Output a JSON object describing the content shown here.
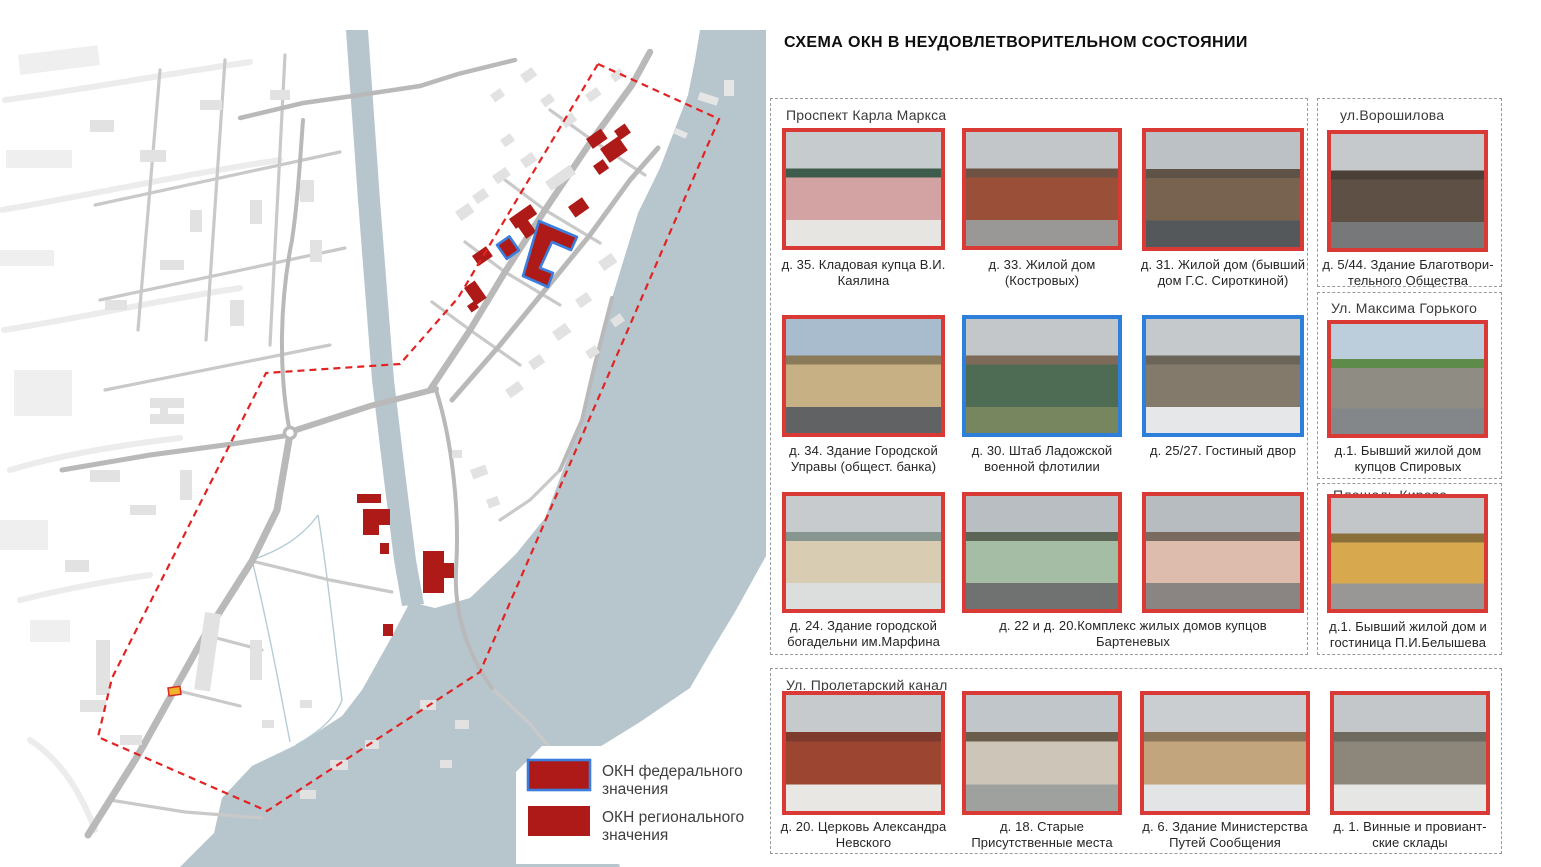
{
  "title": "СХЕМА ОКН В НЕУДОВЛЕТВОРИТЕЛЬНОМ СОСТОЯНИИ",
  "colors": {
    "okn_regional": "#ad1a17",
    "okn_federal_stroke": "#3b7ede",
    "photo_border_red": "#d93a35",
    "photo_border_blue": "#2e7fd9",
    "boundary": "#e32222",
    "water": "#b7c5cd",
    "stream": "#b5ccd6",
    "road": "#b9b9b9",
    "road_minor": "#c9c9c9",
    "building_grey": "#e2e2e2",
    "building_pale": "#efefef",
    "okn_proposed_yellow": "#f2b22c",
    "legend_text": "#3f3f3f"
  },
  "legend": {
    "items": [
      {
        "type": "federal",
        "line1": "ОКН федерального",
        "line2": "значения"
      },
      {
        "type": "regional",
        "line1": "ОКН регионального",
        "line2": "значения"
      }
    ]
  },
  "groups": [
    {
      "label": "Проспект Карла Маркса"
    },
    {
      "label": "ул.Ворошилова"
    },
    {
      "label": "Ул. Максима Горького"
    },
    {
      "label": "Площадь Кирова"
    },
    {
      "label": "Ул. Пролетарский канал"
    }
  ],
  "photos": [
    {
      "caption": "д. 35. Кладовая купца В.И. Каялина",
      "border": "red",
      "palette": {
        "sky": "#c6cbce",
        "roof": "#3d5c4b",
        "wall": "#d3a3a3",
        "ground": "#e7e5e2"
      }
    },
    {
      "caption": "д. 33. Жилой дом (Костровых)",
      "border": "red",
      "palette": {
        "sky": "#c2c6c9",
        "roof": "#6e5243",
        "wall": "#9a5038",
        "ground": "#9a9896"
      }
    },
    {
      "caption": "д. 31. Жилой дом (бывший дом Г.С. Сироткиной)",
      "border": "red",
      "palette": {
        "sky": "#bcc1c5",
        "roof": "#5f5348",
        "wall": "#77634f",
        "ground": "#55585a"
      }
    },
    {
      "caption": "д. 5/44. Здание Благотвори-тельного Общества",
      "border": "red",
      "palette": {
        "sky": "#c5c9cb",
        "roof": "#4a4038",
        "wall": "#5e5044",
        "ground": "#767879"
      }
    },
    {
      "caption": "д. 34. Здание Городской Управы (общест. банка)",
      "border": "red",
      "palette": {
        "sky": "#a9bccd",
        "roof": "#8a7a5a",
        "wall": "#c7b184",
        "ground": "#606264"
      }
    },
    {
      "caption": "д. 30. Штаб Ладожской военной флотилии",
      "border": "blue",
      "palette": {
        "sky": "#c3c7c9",
        "roof": "#7e6a58",
        "wall": "#4e6b54",
        "ground": "#77865f"
      }
    },
    {
      "caption": "д. 25/27. Гостиный двор",
      "border": "blue",
      "palette": {
        "sky": "#c5c9cb",
        "roof": "#6b6458",
        "wall": "#837a6b",
        "ground": "#e6e7e8"
      }
    },
    {
      "caption": "д.1. Бывший жилой дом купцов Спировых",
      "border": "red",
      "palette": {
        "sky": "#bccddb",
        "roof": "#5d8c4a",
        "wall": "#8f8d83",
        "ground": "#83878a"
      }
    },
    {
      "caption": "д. 24. Здание городской богадельни им.Марфина",
      "border": "red",
      "palette": {
        "sky": "#c7cbcd",
        "roof": "#87978f",
        "wall": "#d8ccb2",
        "ground": "#dcdddd"
      }
    },
    {
      "caption": "д. 22 и д. 20.Комплекс жилых домов купцов Бартеневых",
      "border": "red",
      "palette": {
        "sky": "#b9bec2",
        "roof": "#5c6657",
        "wall": "#a5bda4",
        "ground": "#6f7270"
      }
    },
    {
      "caption": "",
      "border": "red",
      "palette": {
        "sky": "#b7bcc0",
        "roof": "#7a6a60",
        "wall": "#ddbcae",
        "ground": "#8a8582"
      }
    },
    {
      "caption": "д.1. Бывший жилой дом и гостиница П.И.Белышева",
      "border": "red",
      "palette": {
        "sky": "#c2c6c9",
        "roof": "#8a6f3a",
        "wall": "#d8a84e",
        "ground": "#989796"
      }
    },
    {
      "caption": "д. 20. Церковь Александра Невского",
      "border": "red",
      "palette": {
        "sky": "#c6cacc",
        "roof": "#7e3a2c",
        "wall": "#9c4631",
        "ground": "#e9e7e3"
      }
    },
    {
      "caption": "д. 18. Старые Присутственные места",
      "border": "red",
      "palette": {
        "sky": "#c0c6ca",
        "roof": "#6a5d4b",
        "wall": "#cdc6b8",
        "ground": "#9fa19f"
      }
    },
    {
      "caption": "д. 6. Здание Министерства Путей Сообщения",
      "border": "red",
      "palette": {
        "sky": "#caced0",
        "roof": "#8a7458",
        "wall": "#c2a57c",
        "ground": "#e3e4e5"
      }
    },
    {
      "caption": "д. 1. Винные и провиант-ские склады",
      "border": "red",
      "palette": {
        "sky": "#c4c7c9",
        "roof": "#6f6a60",
        "wall": "#8d867a",
        "ground": "#e6e6e4"
      }
    }
  ]
}
